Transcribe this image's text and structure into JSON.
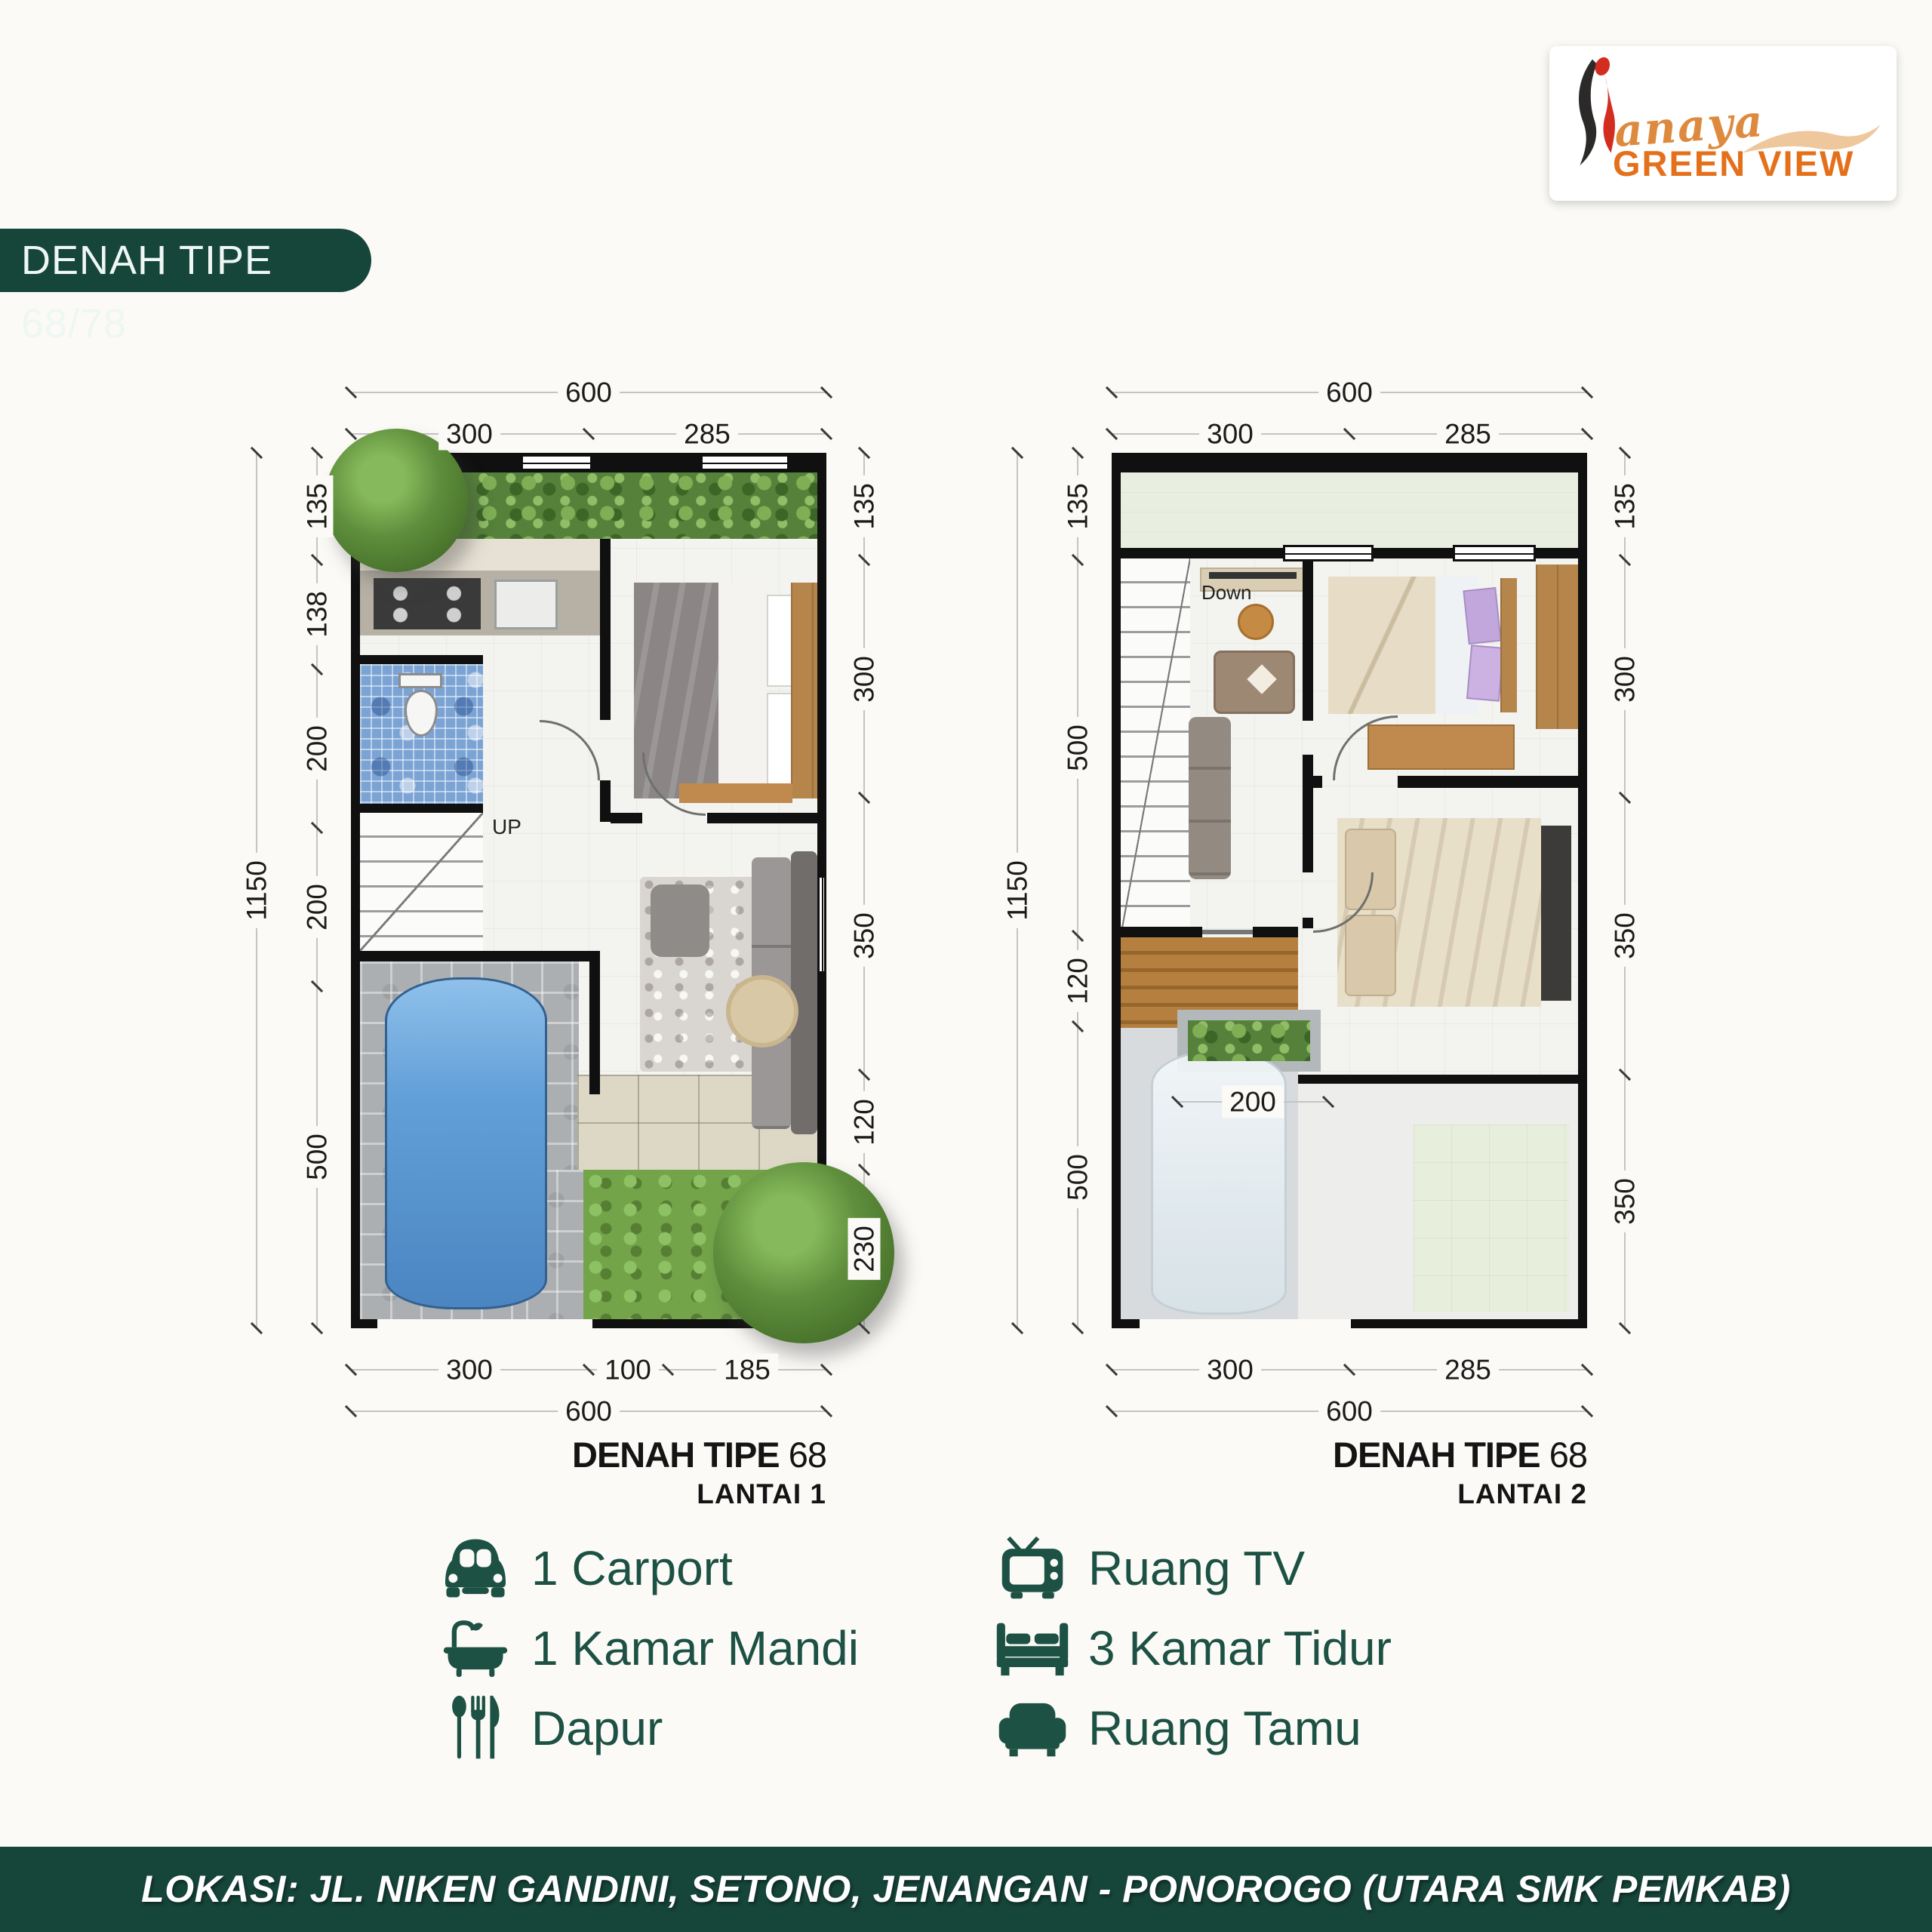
{
  "logo": {
    "script": "anaya",
    "title": "GREEN VIEW"
  },
  "header": {
    "title": "DENAH TIPE 68/78"
  },
  "plan1": {
    "caption_title": "DENAH TIPE",
    "caption_number": "68",
    "caption_floor": "LANTAI 1",
    "stair_label": "UP",
    "dims": {
      "top_total": "600",
      "top_a": "300",
      "top_b": "285",
      "left_total": "1150",
      "l1": "135",
      "l2": "138",
      "l3": "200",
      "l4": "200",
      "l5": "500",
      "r1": "135",
      "r2": "300",
      "r3": "350",
      "r4": "120",
      "r5": "230",
      "b1": "300",
      "b2": "100",
      "b3": "185",
      "bottom_total": "600"
    }
  },
  "plan2": {
    "caption_title": "DENAH TIPE",
    "caption_number": "68",
    "caption_floor": "LANTAI 2",
    "stair_label": "Down",
    "dims": {
      "top_total": "600",
      "top_a": "300",
      "top_b": "285",
      "left_total": "1150",
      "l1": "135",
      "l2": "500",
      "l3": "120",
      "l4": "500",
      "r1": "135",
      "r2": "300",
      "r3": "350",
      "r4": "350",
      "b1": "300",
      "b2": "285",
      "bottom_total": "600",
      "inner": "200"
    }
  },
  "legend": {
    "left": [
      {
        "icon": "car-icon",
        "label": "1 Carport"
      },
      {
        "icon": "bathtub-icon",
        "label": "1 Kamar Mandi"
      },
      {
        "icon": "cutlery-icon",
        "label": "Dapur"
      }
    ],
    "right": [
      {
        "icon": "tv-icon",
        "label": "Ruang TV"
      },
      {
        "icon": "bed-icon",
        "label": "3 Kamar Tidur"
      },
      {
        "icon": "sofa-icon",
        "label": "Ruang Tamu"
      }
    ]
  },
  "footer": {
    "location": "LOKASI: JL. NIKEN GANDINI, SETONO, JENANGAN - PONOROGO (UTARA SMK PEMKAB)"
  },
  "colors": {
    "brand_green": "#16453a",
    "legend_green": "#1d5144",
    "logo_orange": "#e4701b",
    "logo_red": "#d32d20",
    "hedge_green": "#55813a",
    "tile_blue": "#7ba3d4"
  }
}
